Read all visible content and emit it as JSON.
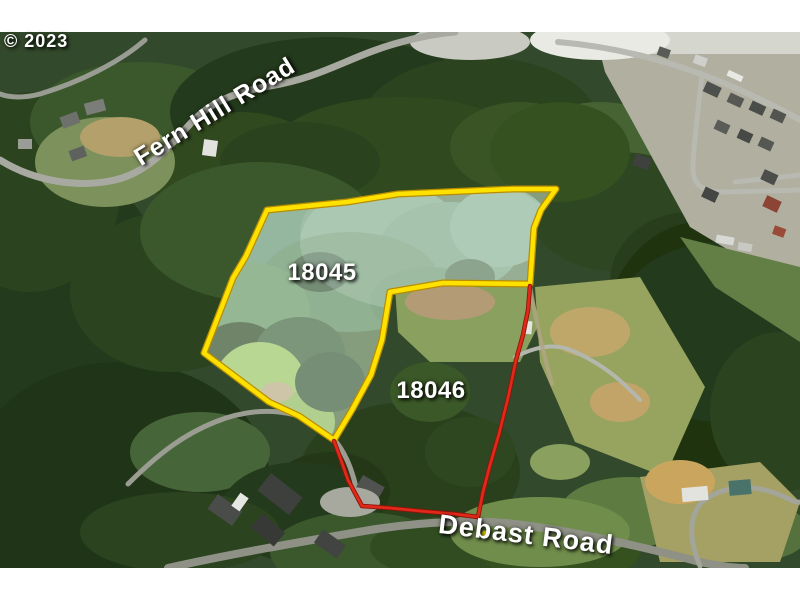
{
  "watermark": {
    "text": "© 2023"
  },
  "roads": [
    {
      "name": "Fern Hill Road"
    },
    {
      "name": "Debast Road"
    }
  ],
  "parcels": [
    {
      "id": "18045",
      "outline_color": "#FFE100"
    },
    {
      "id": "18046",
      "outline_color": "#E0291A"
    }
  ],
  "colors": {
    "label_text": "#FFFFFF",
    "mat_background": "#FFFFFF",
    "road_marker_dot": "#FFE100"
  }
}
